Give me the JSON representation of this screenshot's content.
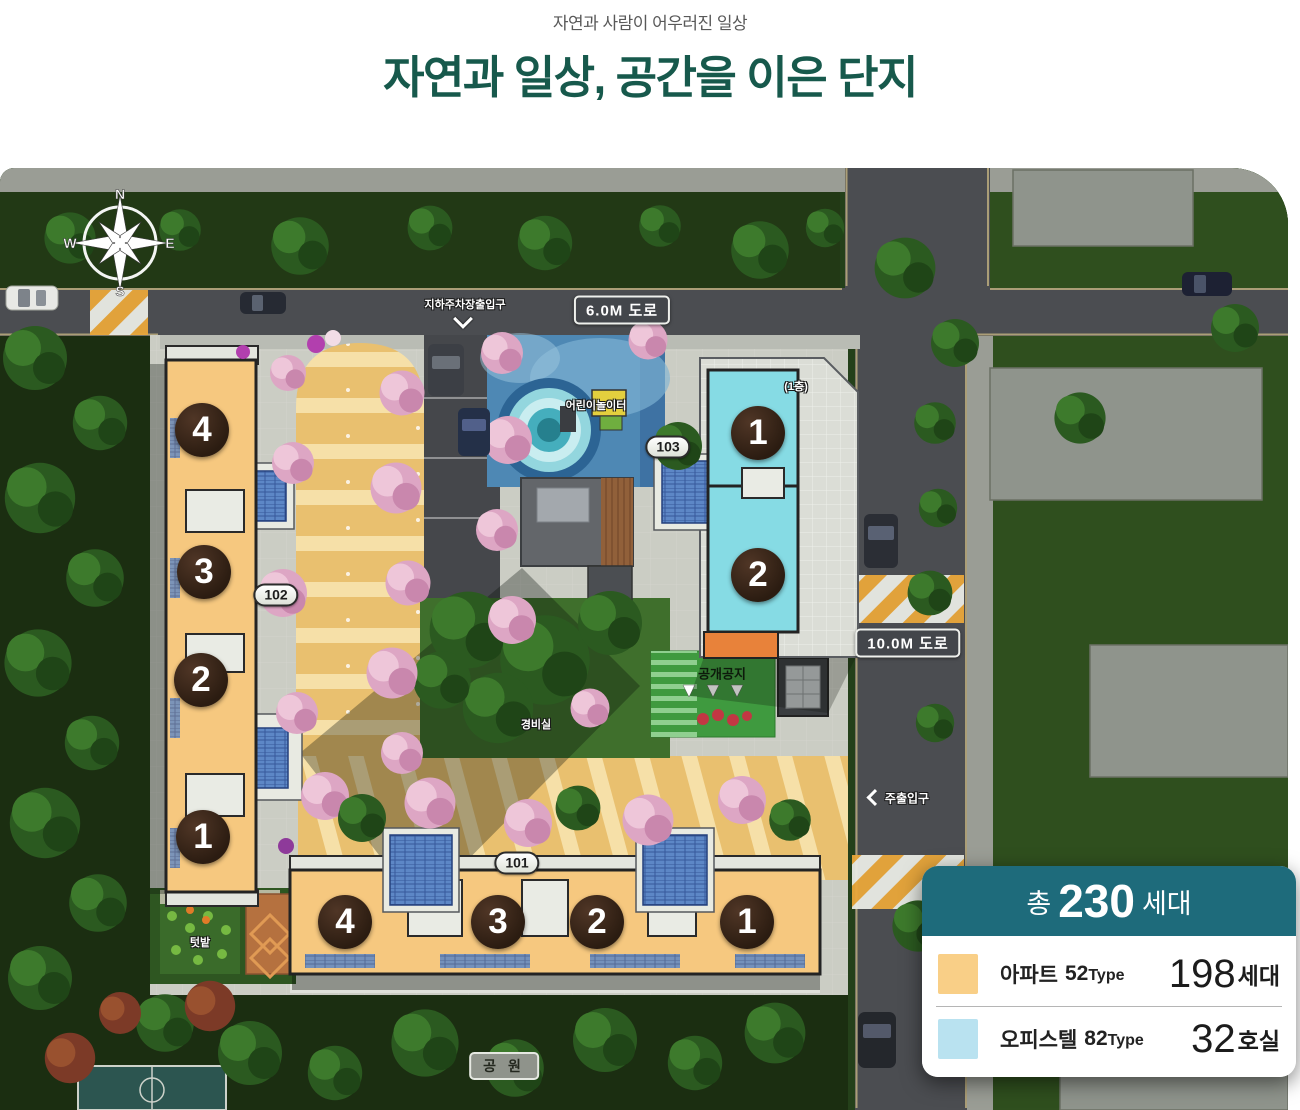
{
  "header": {
    "subtitle": "자연과 사람이 어우러진 일상",
    "title": "자연과 일상, 공간을 이은 단지"
  },
  "compass": {
    "n": "N",
    "e": "E",
    "s": "S",
    "w": "W"
  },
  "map": {
    "labels": {
      "parking_entrance": "지하주차장출입구",
      "road_6m": "6.0M 도로",
      "road_10m": "10.0M 도로",
      "playground": "어린이놀이터",
      "public_space": "공개공지",
      "security_office": "경비실",
      "main_entrance": "주출입구",
      "garden": "텃밭",
      "park": "공 원",
      "first_floor": "(1층)"
    },
    "buildings": {
      "b101": {
        "id": "101",
        "units": [
          "4",
          "3",
          "2",
          "1"
        ]
      },
      "b102": {
        "id": "102",
        "units": [
          "4",
          "3",
          "2",
          "1"
        ]
      },
      "b103": {
        "id": "103",
        "units": [
          "1",
          "2"
        ]
      }
    }
  },
  "legend": {
    "total_prefix": "총",
    "total_count": "230",
    "total_unit": "세대",
    "rows": [
      {
        "name": "아파트",
        "type_num": "52",
        "type_suffix": "Type",
        "count": "198",
        "unit": "세대",
        "swatch": "#f9cf87"
      },
      {
        "name": "오피스텔",
        "type_num": "82",
        "type_suffix": "Type",
        "count": "32",
        "unit": "호실",
        "swatch": "#b9e2f0"
      }
    ]
  },
  "colors": {
    "title_teal": "#17594c",
    "legend_header_teal": "#1e6b7b",
    "apartment_orange": "#f6c87f",
    "officetel_blue": "#86dbe4"
  }
}
